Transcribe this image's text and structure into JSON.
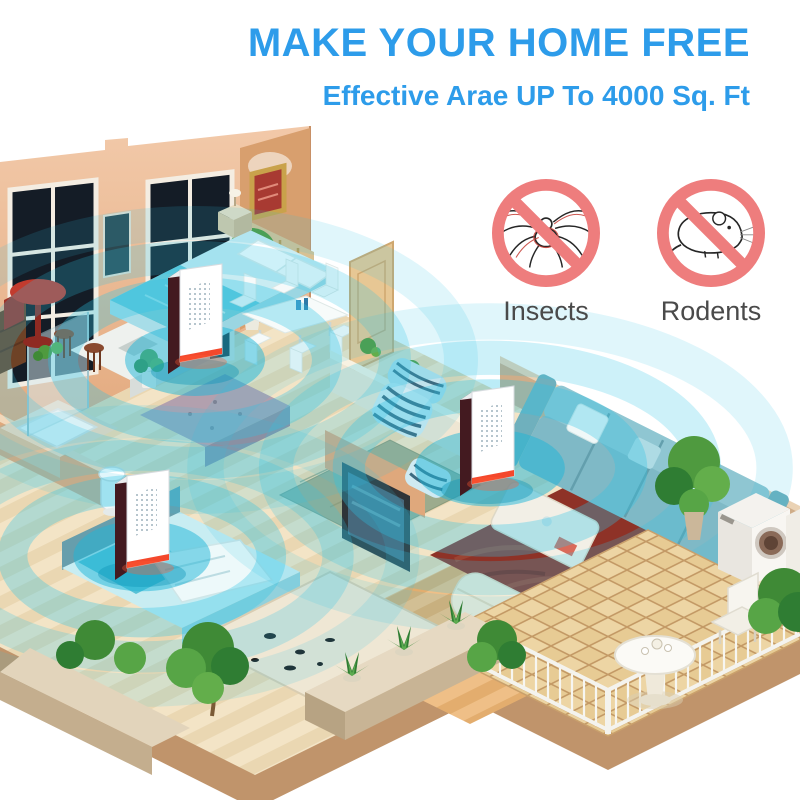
{
  "header": {
    "title": "MAKE YOUR HOME FREE",
    "subtitle": "Effective Arae UP To 4000 Sq. Ft"
  },
  "prohibitions": [
    {
      "label": "Insects",
      "icon": "no-insects-icon",
      "animal": "spider"
    },
    {
      "label": "Rodents",
      "icon": "no-rodents-icon",
      "animal": "mouse"
    }
  ],
  "colors": {
    "headline_blue": "#2d9cea",
    "prohibition_red": "#ee7d7d",
    "wave_cyan": "#2cc4e6",
    "wall_tan": "#eebf9e",
    "label_gray": "#4a4a4a",
    "background": "#ffffff"
  },
  "illustration": {
    "alt": "Isometric cutaway of a home where three plug-in ultrasonic pest repellers emit cyan coverage waves across the bedrooms, dining area, living room, bathroom and balcony",
    "repeller_count": 3
  }
}
